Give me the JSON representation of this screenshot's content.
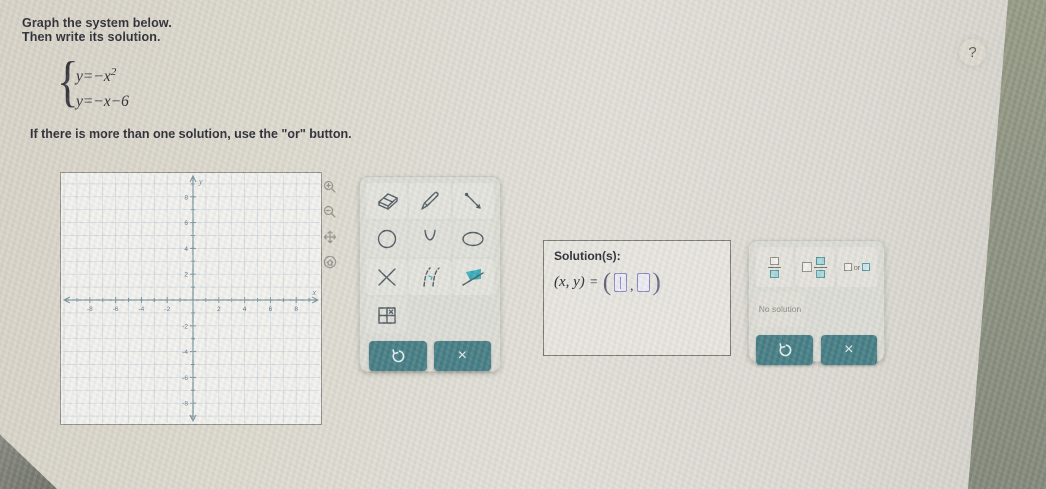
{
  "problem": {
    "instruction_line1": "Graph the system below.",
    "instruction_line2": "Then write its solution.",
    "eq1_base": "y=−x",
    "eq1_exp": "2",
    "eq2": "y=−x−6",
    "note": "If there is more than one solution, use the \"or\" button."
  },
  "help": {
    "label": "?"
  },
  "graph": {
    "xlabel": "x",
    "ylabel": "y",
    "x_ticks_labeled": [
      -8,
      -6,
      -4,
      -2,
      2,
      4,
      6,
      8
    ],
    "y_ticks_labeled": [
      8,
      6,
      4,
      2,
      -2,
      -4,
      -6,
      -8
    ],
    "x_range": [
      -10,
      10
    ],
    "y_range": [
      -9.7,
      9.7
    ],
    "minor_grid_step": 1,
    "grid_on": true
  },
  "graph_controls": [
    "zoom-in",
    "zoom-out",
    "pan",
    "reset-view"
  ],
  "toolbar": {
    "tools": [
      "eraser",
      "pencil",
      "line",
      "circle",
      "parabola",
      "ellipse",
      "cross-out",
      "dashed-curve",
      "region-fill",
      "point-table"
    ],
    "undo_label": "undo",
    "close_glyph": "×"
  },
  "solution": {
    "label": "Solution(s):",
    "lhs": "(x, y)",
    "equals": "=",
    "paren_open": "(",
    "comma": ",",
    "paren_close": ")"
  },
  "answer_controls": {
    "fraction_button": "fraction",
    "mixed_number_button": "mixed-number",
    "or_text": "or",
    "no_solution_label": "No solution",
    "undo_label": "undo",
    "close_glyph": "×"
  },
  "colors": {
    "accent_teal": "#3c7880",
    "tool_fill_teal": "#2fa9b8",
    "answer_input_border": "#8583c2",
    "screen_edge": "#878d7b"
  }
}
